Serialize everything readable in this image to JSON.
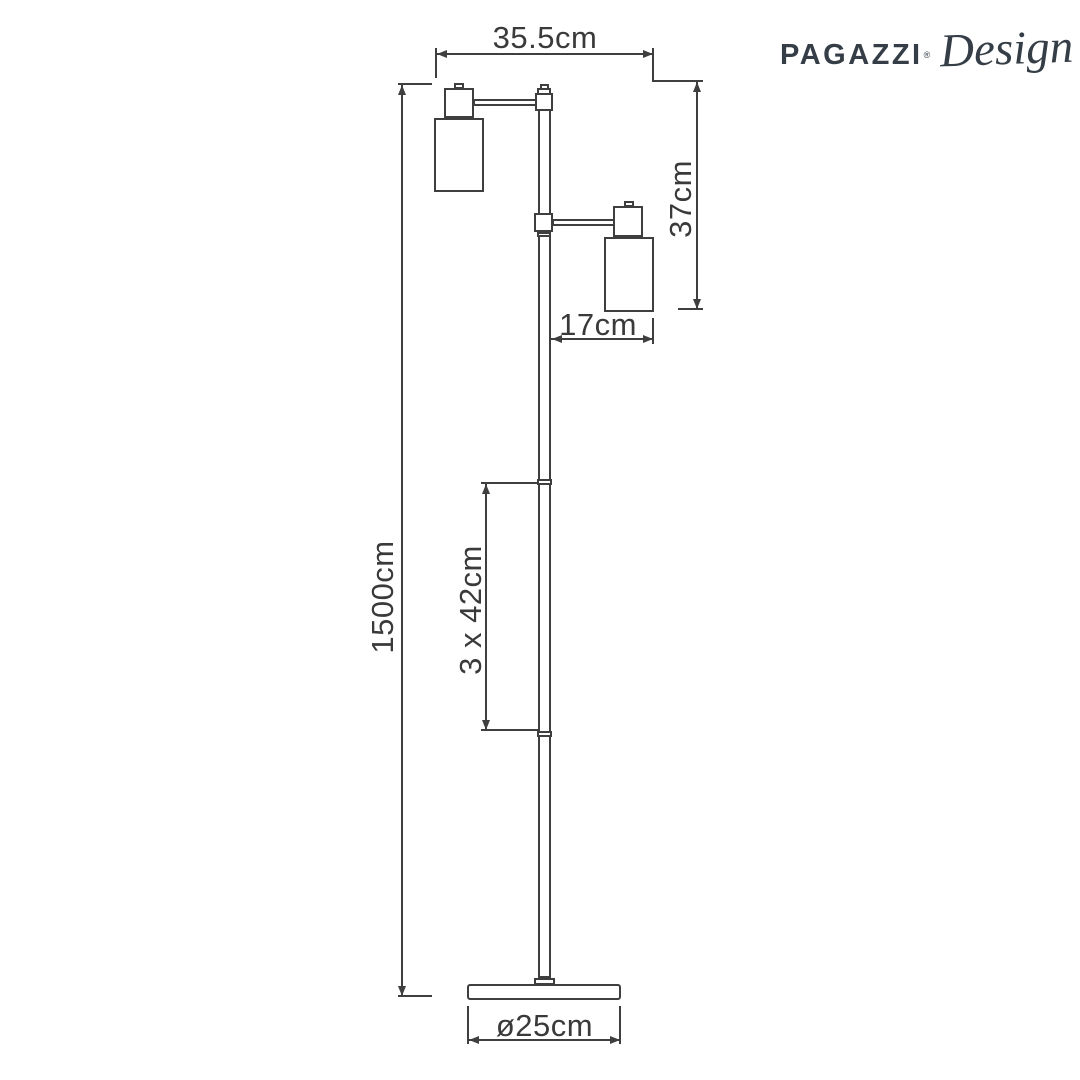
{
  "logo": {
    "brand": "PAGAZZI",
    "mark": "®",
    "suffix": "Design"
  },
  "dimensions": {
    "top_width": {
      "label": "35.5cm"
    },
    "head_height": {
      "label": "37cm"
    },
    "arm_offset": {
      "label": "17cm"
    },
    "total_height": {
      "label": "1500cm"
    },
    "pole_sections": {
      "label": "3 x 42cm"
    },
    "base_diameter": {
      "label": "ø25cm"
    }
  },
  "colors": {
    "ink": "#3f3f3f",
    "text": "#3a3a3a",
    "logo": "#353e46",
    "background": "#ffffff"
  }
}
